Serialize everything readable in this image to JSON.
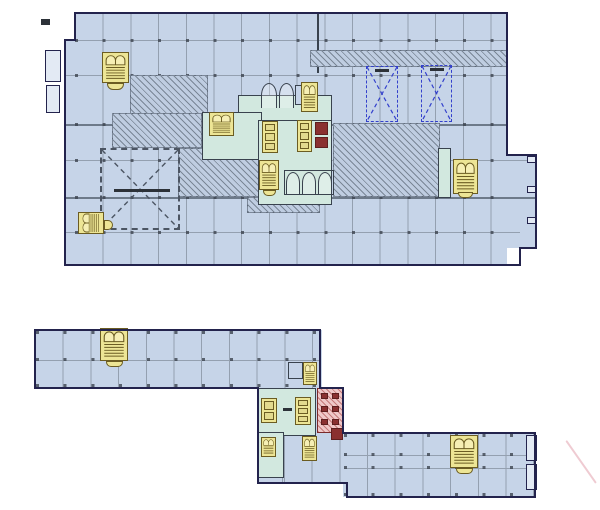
{
  "title": "Two-level architectural floor plan drawing",
  "drawing": {
    "type": "CAD floor plan",
    "views": [
      "upper-level-floor-plan",
      "lower-level-floor-plan"
    ],
    "visible_text": "none (annotation tags are illegible at this scale)"
  },
  "colors": {
    "background": "#ffffff",
    "slab": "#c6d4e8",
    "slab_shaded": "#bfcde1",
    "grid_line": "#94a0b0",
    "column_marker": "#3d4450",
    "outline": "#23234d",
    "wall": "#39424e",
    "core_room": "#d2e8df",
    "stair_fill": "#ede595",
    "stair_line": "#6b5c22",
    "elevator_cab": "#e3da8e",
    "shaft_dash": "#3340cc",
    "void_dash": "#4c5563",
    "wet_wall": "#efc8c8",
    "fixture": "#8a3030",
    "panel": "#e3eaf4",
    "annotation": "#2c3138",
    "curve": "#e4a9b4"
  },
  "upper_plan": {
    "features": [
      "floor-slab-with-structural-grid",
      "left-exit-stair",
      "core-stairs",
      "elevator-banks",
      "two-dashed-shaft-openings-with-x",
      "large-dashed-void-with-x",
      "hatched-circulation-band",
      "right-exit-stair",
      "edge-balcony-notches"
    ]
  },
  "lower_plan": {
    "features": [
      "left-wing-slab",
      "right-wing-slab",
      "central-core",
      "wet-room-red-hatch",
      "elevator-banks",
      "exit-stairs",
      "end-panels"
    ]
  }
}
